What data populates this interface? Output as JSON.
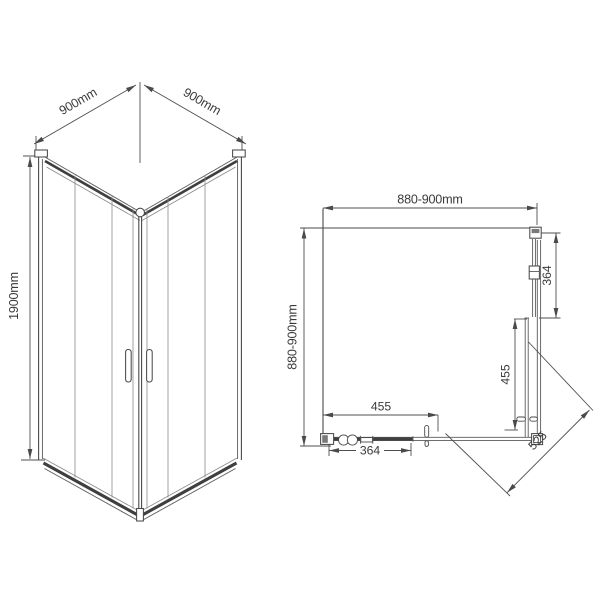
{
  "drawing": {
    "type": "shower-enclosure-technical-drawing",
    "views": [
      "isometric",
      "plan"
    ]
  },
  "iso_view": {
    "dim_top_left_width": "900mm",
    "dim_top_right_width": "900mm",
    "dim_height": "1900mm"
  },
  "plan_view": {
    "dim_width_top": "880-900mm",
    "dim_depth_left": "880-900mm",
    "dim_fixed_panel_right": "364",
    "dim_sliding_door_right": "455",
    "dim_sliding_door_bottom": "455",
    "dim_fixed_panel_bottom": "364",
    "dim_diagonal_entry": "525"
  },
  "colors": {
    "line": "#4a4a4a",
    "text": "#3a3a3a",
    "background": "#ffffff"
  }
}
